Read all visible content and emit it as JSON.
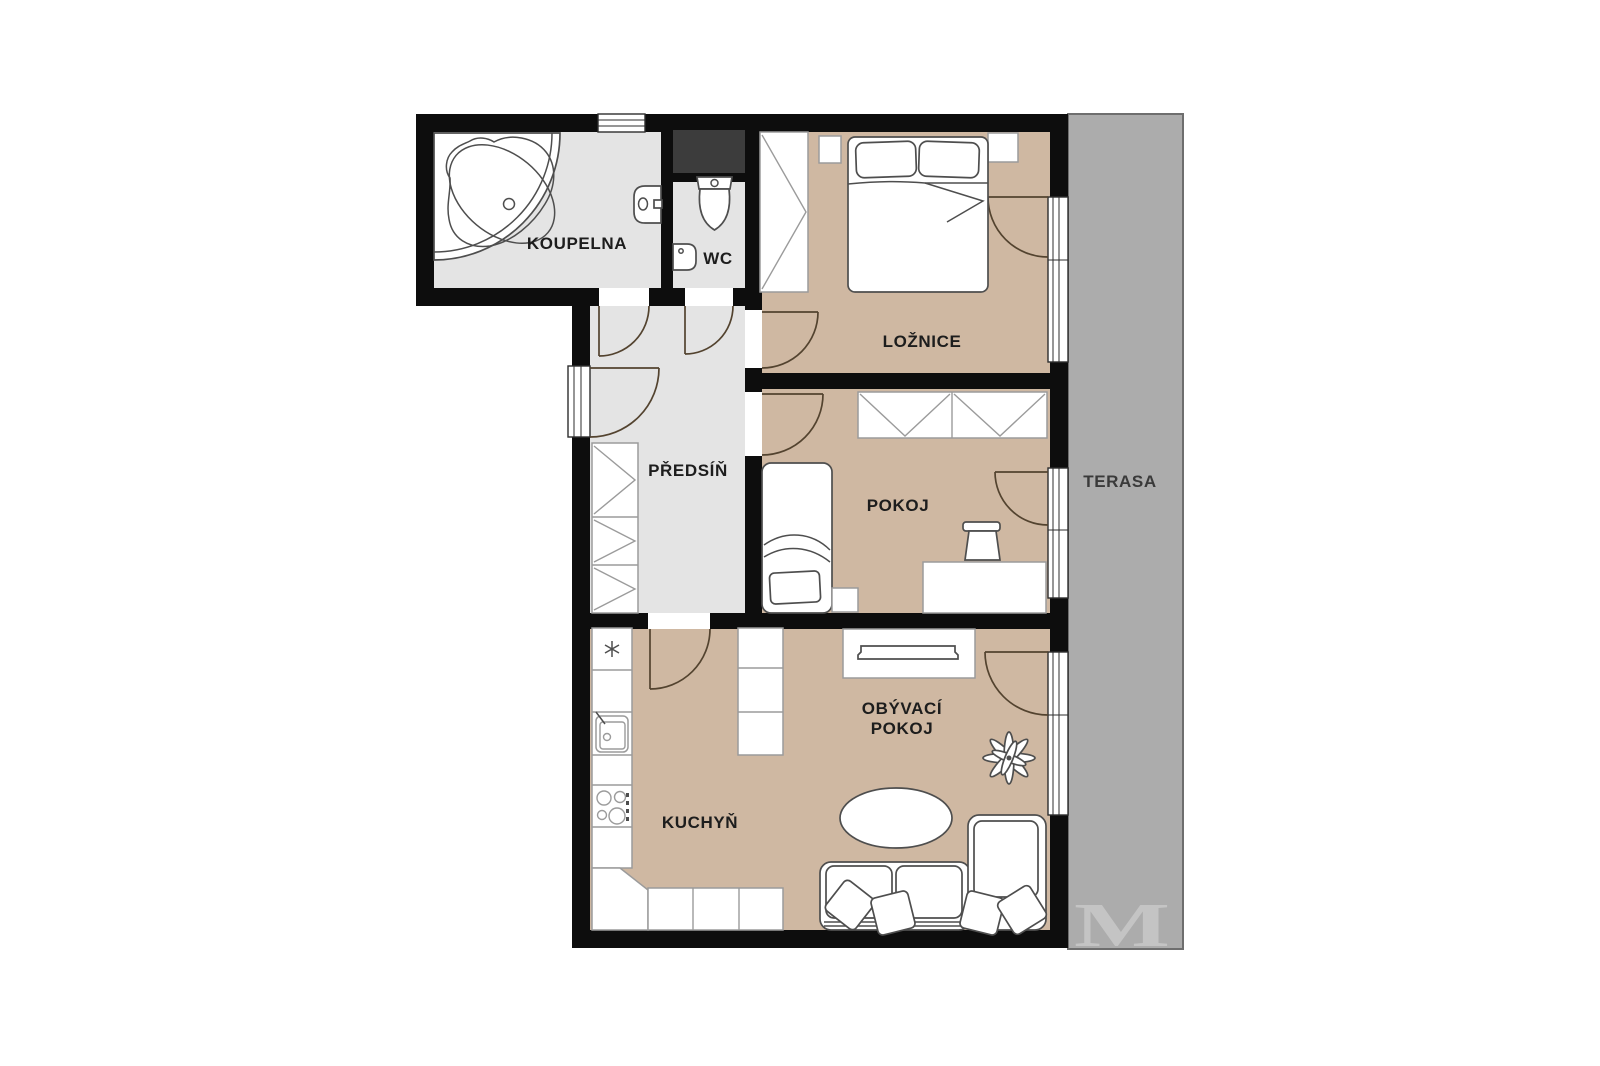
{
  "colors": {
    "wall": "#0d0d0d",
    "floor_wet": "#e4e4e4",
    "floor_room": "#cfb8a2",
    "terrace": "#acacac",
    "terrace_border": "#6e6e6e",
    "shaft": "#3c3c3c",
    "furniture_stroke": "#4e4e4e",
    "counter_stroke": "#9b9b9b",
    "door_arc": "#53432f",
    "label": "#1d1d1d",
    "terrace_label": "#3a3a3a",
    "watermark": "#c4c4c4"
  },
  "rooms": {
    "bathroom": {
      "label": "KOUPELNA"
    },
    "wc": {
      "label": "WC"
    },
    "bedroom": {
      "label": "LOŽNICE"
    },
    "hallway": {
      "label": "PŘEDSÍŇ"
    },
    "kids_room": {
      "label": "POKOJ"
    },
    "kitchen": {
      "label": "KUCHYŇ"
    },
    "living_room": {
      "line1": "OBÝVACÍ",
      "line2": "POKOJ"
    },
    "terrace": {
      "label": "TERASA"
    }
  },
  "watermark": {
    "text": "M"
  }
}
